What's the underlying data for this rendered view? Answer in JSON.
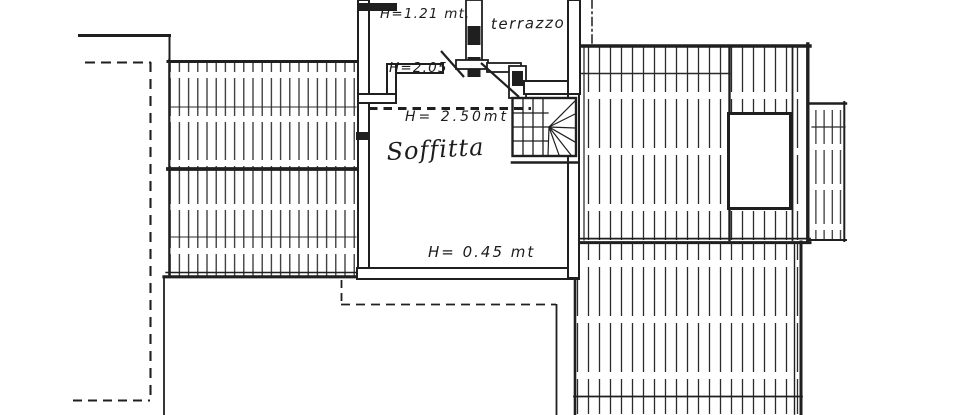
{
  "plan": {
    "ink_color": "#1f1f1f",
    "paper_color": "#ffffff",
    "labels": {
      "upper_room_height": "H=1.21 mt.",
      "passage_height": "H=2.05",
      "terrace": "terrazzo",
      "attic_height": "H= 2.50mt",
      "attic_name": "Soffitta",
      "eaves_height": "H= 0.45 mt"
    }
  }
}
